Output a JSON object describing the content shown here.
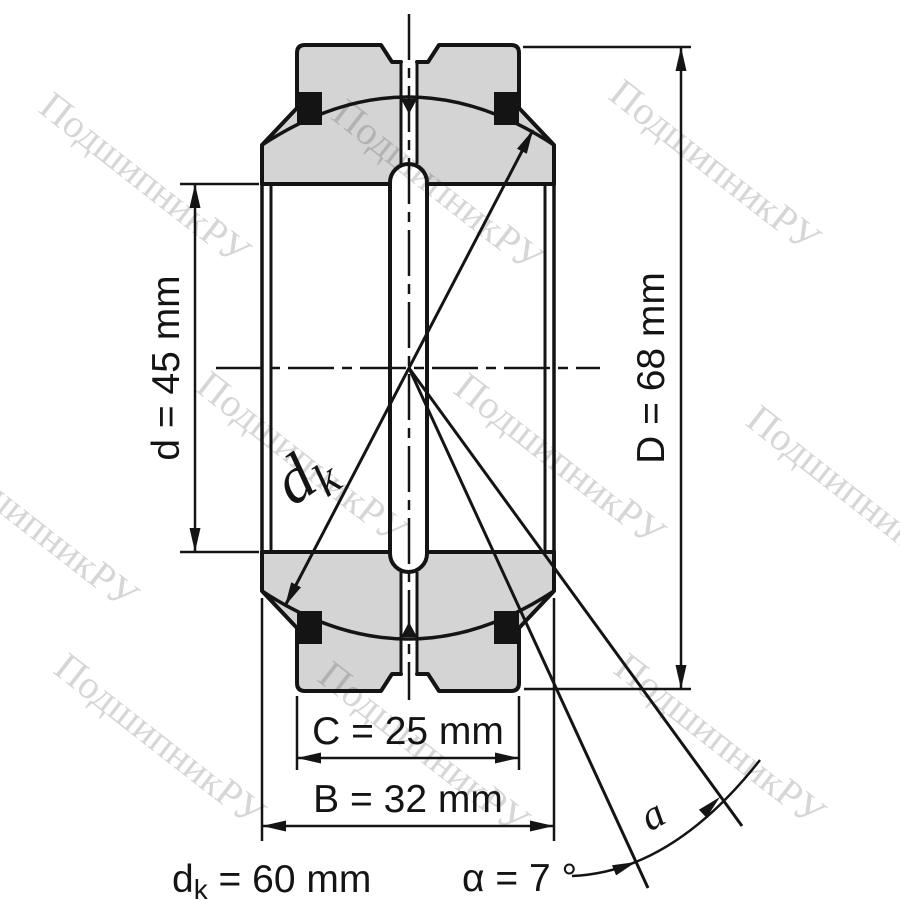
{
  "page": {
    "background": "#ffffff",
    "description": "Dimensional drawing of a radial spherical plain bearing"
  },
  "watermark": {
    "text": "ПодшипникРУ",
    "color": "#000000",
    "opacity": "0.16"
  },
  "drawing": {
    "fill_color": "#d4d4d4",
    "line_color": "#141414",
    "dimensions": {
      "bore_diameter": "d = 45 mm",
      "outer_diameter": "D = 68 mm",
      "outer_ring_width": "C = 25 mm",
      "inner_ring_width": "B = 32 mm",
      "sphere_symbol": "d",
      "sphere_subscript": "k",
      "sphere_value": " = 60 mm",
      "tilt_angle": "α = 7 °",
      "angle_arc_label": "a"
    }
  }
}
